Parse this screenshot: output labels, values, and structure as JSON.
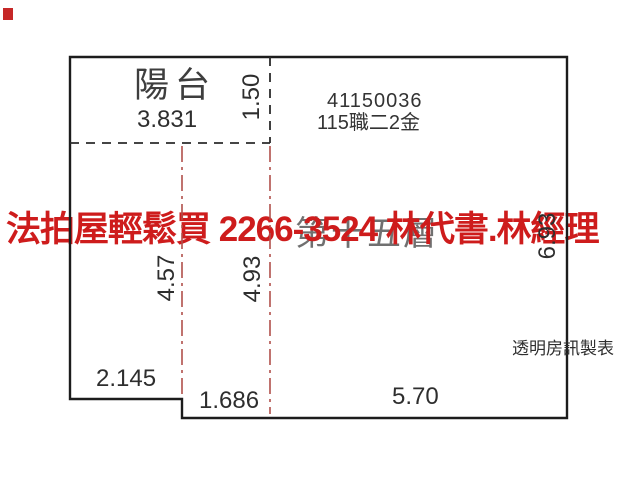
{
  "plan": {
    "balcony_label": "陽台",
    "balcony_width": "3.831",
    "balcony_depth": "1.50",
    "case_number": "41150036",
    "case_label": "115職二2金",
    "floor_label": "第十五層",
    "dim_left": "4.57",
    "dim_mid": "4.93",
    "dim_right": "6.93",
    "dim_bottom_left": "2.145",
    "dim_bottom_step": "1.686",
    "dim_bottom_main": "5.70",
    "credit_label": "透明房訊製表"
  },
  "watermark": {
    "text": "法拍屋輕鬆買 2266-3524 林代書.林經理",
    "color": "#ce1c1c"
  },
  "colors": {
    "wall": "#1c1c1c",
    "dash": "#2b2b2b",
    "boundary_red": "#b0504b",
    "corner_mark": "#c62828"
  }
}
